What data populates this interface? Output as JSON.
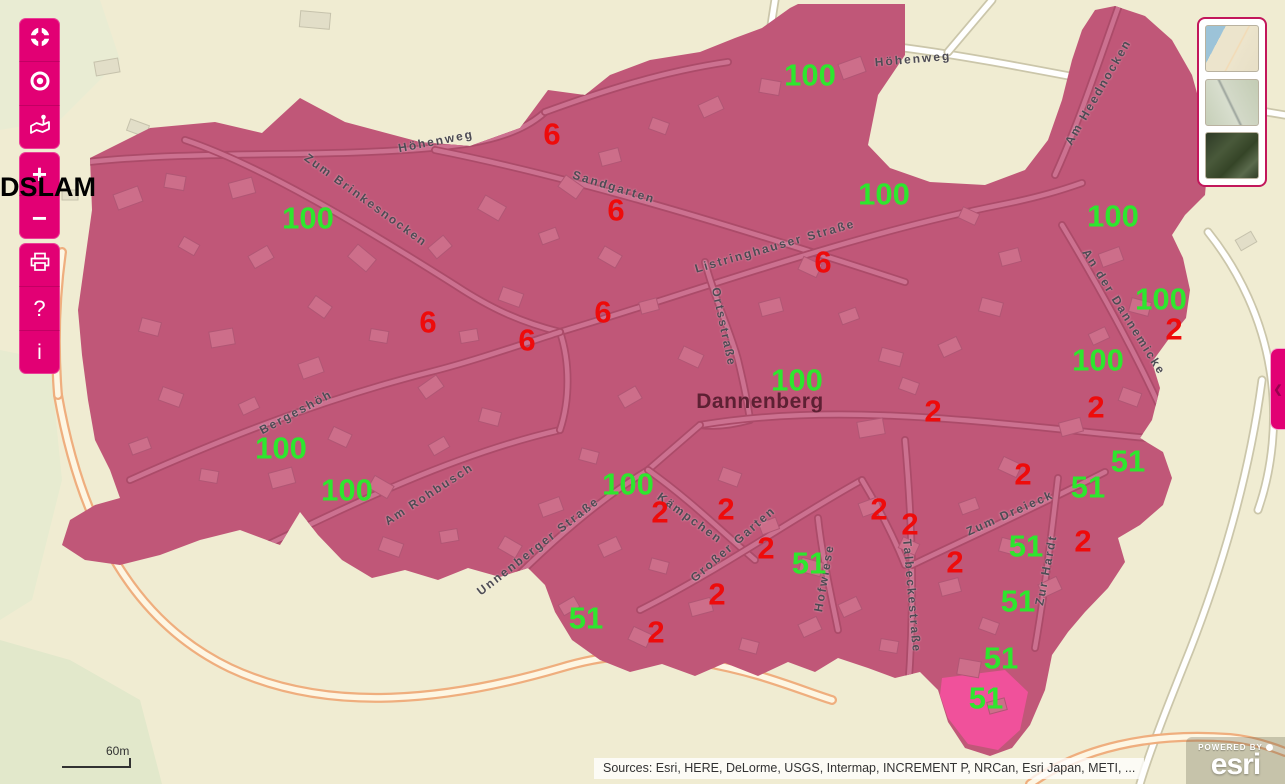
{
  "colors": {
    "accent": "#e20074",
    "map_background": "#f0ecd2",
    "coverage": "#c05778",
    "coverage_highlight": "#f0519b",
    "building": "#cd6e8a",
    "road_inside": "#cc7190",
    "road_inside_casing": "#ab4b69",
    "green": "#2ee62e",
    "red": "#ee0b0b"
  },
  "toolbar": {
    "zoom_in_label": "+",
    "zoom_out_label": "−",
    "help_label": "?",
    "info_label": "i",
    "icons": [
      "extent-icon",
      "locate-icon",
      "basemap-pin-icon",
      "printer-icon"
    ]
  },
  "side_tab": {
    "chevron": "❮"
  },
  "basemap_gallery": {
    "items": [
      {
        "name": "streets-thumbnail"
      },
      {
        "name": "topographic-thumbnail"
      },
      {
        "name": "imagery-thumbnail"
      }
    ]
  },
  "scale_bar": {
    "label": "60m"
  },
  "attribution": {
    "text": "Sources: Esri, HERE, DeLorme, USGS, Intermap, INCREMENT P, NRCan, Esri Japan, METI, ..."
  },
  "esri_logo": {
    "powered_by": "POWERED BY",
    "brand": "esri"
  },
  "map": {
    "dslam_label": "DSLAM",
    "place_label": {
      "text": "Dannenberg",
      "x": 760,
      "y": 402
    },
    "street_labels": [
      {
        "text": "Höhenweg",
        "x": 913,
        "y": 59,
        "rot": -5
      },
      {
        "text": "Höhenweg",
        "x": 436,
        "y": 141,
        "rot": -11
      },
      {
        "text": "Sandgarten",
        "x": 614,
        "y": 187,
        "rot": 17
      },
      {
        "text": "Zum Brinkesnocken",
        "x": 366,
        "y": 200,
        "rot": 36
      },
      {
        "text": "Listringhauser Straße",
        "x": 775,
        "y": 246,
        "rot": -16
      },
      {
        "text": "Ortsstraße",
        "x": 724,
        "y": 327,
        "rot": 78
      },
      {
        "text": "Am Heednocken",
        "x": 1098,
        "y": 92,
        "rot": -60
      },
      {
        "text": "An der Dannemicke",
        "x": 1124,
        "y": 312,
        "rot": 58
      },
      {
        "text": "Bergeshöh",
        "x": 296,
        "y": 412,
        "rot": -28
      },
      {
        "text": "Am Rohbusch",
        "x": 429,
        "y": 494,
        "rot": -33
      },
      {
        "text": "Unnenberger Straße",
        "x": 538,
        "y": 546,
        "rot": -38
      },
      {
        "text": "Kämpchen",
        "x": 690,
        "y": 518,
        "rot": 36
      },
      {
        "text": "Großer Garten",
        "x": 733,
        "y": 544,
        "rot": -41
      },
      {
        "text": "Hofwiese",
        "x": 824,
        "y": 578,
        "rot": -80
      },
      {
        "text": "Talbeckestraße",
        "x": 912,
        "y": 596,
        "rot": 85
      },
      {
        "text": "Zum Dreieck",
        "x": 1010,
        "y": 513,
        "rot": -24
      },
      {
        "text": "Zur Hardt",
        "x": 1046,
        "y": 570,
        "rot": -79
      }
    ],
    "value_labels": [
      {
        "text": "100",
        "x": 810,
        "y": 75,
        "color": "green"
      },
      {
        "text": "6",
        "x": 552,
        "y": 134,
        "color": "red"
      },
      {
        "text": "100",
        "x": 308,
        "y": 218,
        "color": "green"
      },
      {
        "text": "6",
        "x": 616,
        "y": 210,
        "color": "red"
      },
      {
        "text": "100",
        "x": 884,
        "y": 194,
        "color": "green"
      },
      {
        "text": "100",
        "x": 1113,
        "y": 216,
        "color": "green"
      },
      {
        "text": "6",
        "x": 823,
        "y": 262,
        "color": "red"
      },
      {
        "text": "100",
        "x": 1161,
        "y": 299,
        "color": "green"
      },
      {
        "text": "2",
        "x": 1174,
        "y": 329,
        "color": "red"
      },
      {
        "text": "6",
        "x": 603,
        "y": 312,
        "color": "red"
      },
      {
        "text": "6",
        "x": 428,
        "y": 322,
        "color": "red"
      },
      {
        "text": "6",
        "x": 527,
        "y": 340,
        "color": "red"
      },
      {
        "text": "100",
        "x": 1098,
        "y": 360,
        "color": "green"
      },
      {
        "text": "100",
        "x": 797,
        "y": 380,
        "color": "green"
      },
      {
        "text": "2",
        "x": 1096,
        "y": 407,
        "color": "red"
      },
      {
        "text": "2",
        "x": 933,
        "y": 411,
        "color": "red"
      },
      {
        "text": "100",
        "x": 281,
        "y": 448,
        "color": "green"
      },
      {
        "text": "51",
        "x": 1128,
        "y": 461,
        "color": "green"
      },
      {
        "text": "2",
        "x": 1023,
        "y": 474,
        "color": "red"
      },
      {
        "text": "100",
        "x": 347,
        "y": 490,
        "color": "green"
      },
      {
        "text": "100",
        "x": 628,
        "y": 484,
        "color": "green"
      },
      {
        "text": "51",
        "x": 1088,
        "y": 487,
        "color": "green"
      },
      {
        "text": "2",
        "x": 660,
        "y": 512,
        "color": "red"
      },
      {
        "text": "2",
        "x": 726,
        "y": 509,
        "color": "red"
      },
      {
        "text": "2",
        "x": 879,
        "y": 509,
        "color": "red"
      },
      {
        "text": "2",
        "x": 910,
        "y": 524,
        "color": "red"
      },
      {
        "text": "2",
        "x": 1083,
        "y": 541,
        "color": "red"
      },
      {
        "text": "51",
        "x": 1026,
        "y": 546,
        "color": "green"
      },
      {
        "text": "2",
        "x": 766,
        "y": 548,
        "color": "red"
      },
      {
        "text": "51",
        "x": 809,
        "y": 563,
        "color": "green"
      },
      {
        "text": "2",
        "x": 955,
        "y": 562,
        "color": "red"
      },
      {
        "text": "2",
        "x": 717,
        "y": 594,
        "color": "red"
      },
      {
        "text": "51",
        "x": 1018,
        "y": 601,
        "color": "green"
      },
      {
        "text": "51",
        "x": 586,
        "y": 618,
        "color": "green"
      },
      {
        "text": "2",
        "x": 656,
        "y": 632,
        "color": "red"
      },
      {
        "text": "51",
        "x": 1001,
        "y": 658,
        "color": "green"
      },
      {
        "text": "51",
        "x": 986,
        "y": 698,
        "color": "green"
      }
    ]
  }
}
